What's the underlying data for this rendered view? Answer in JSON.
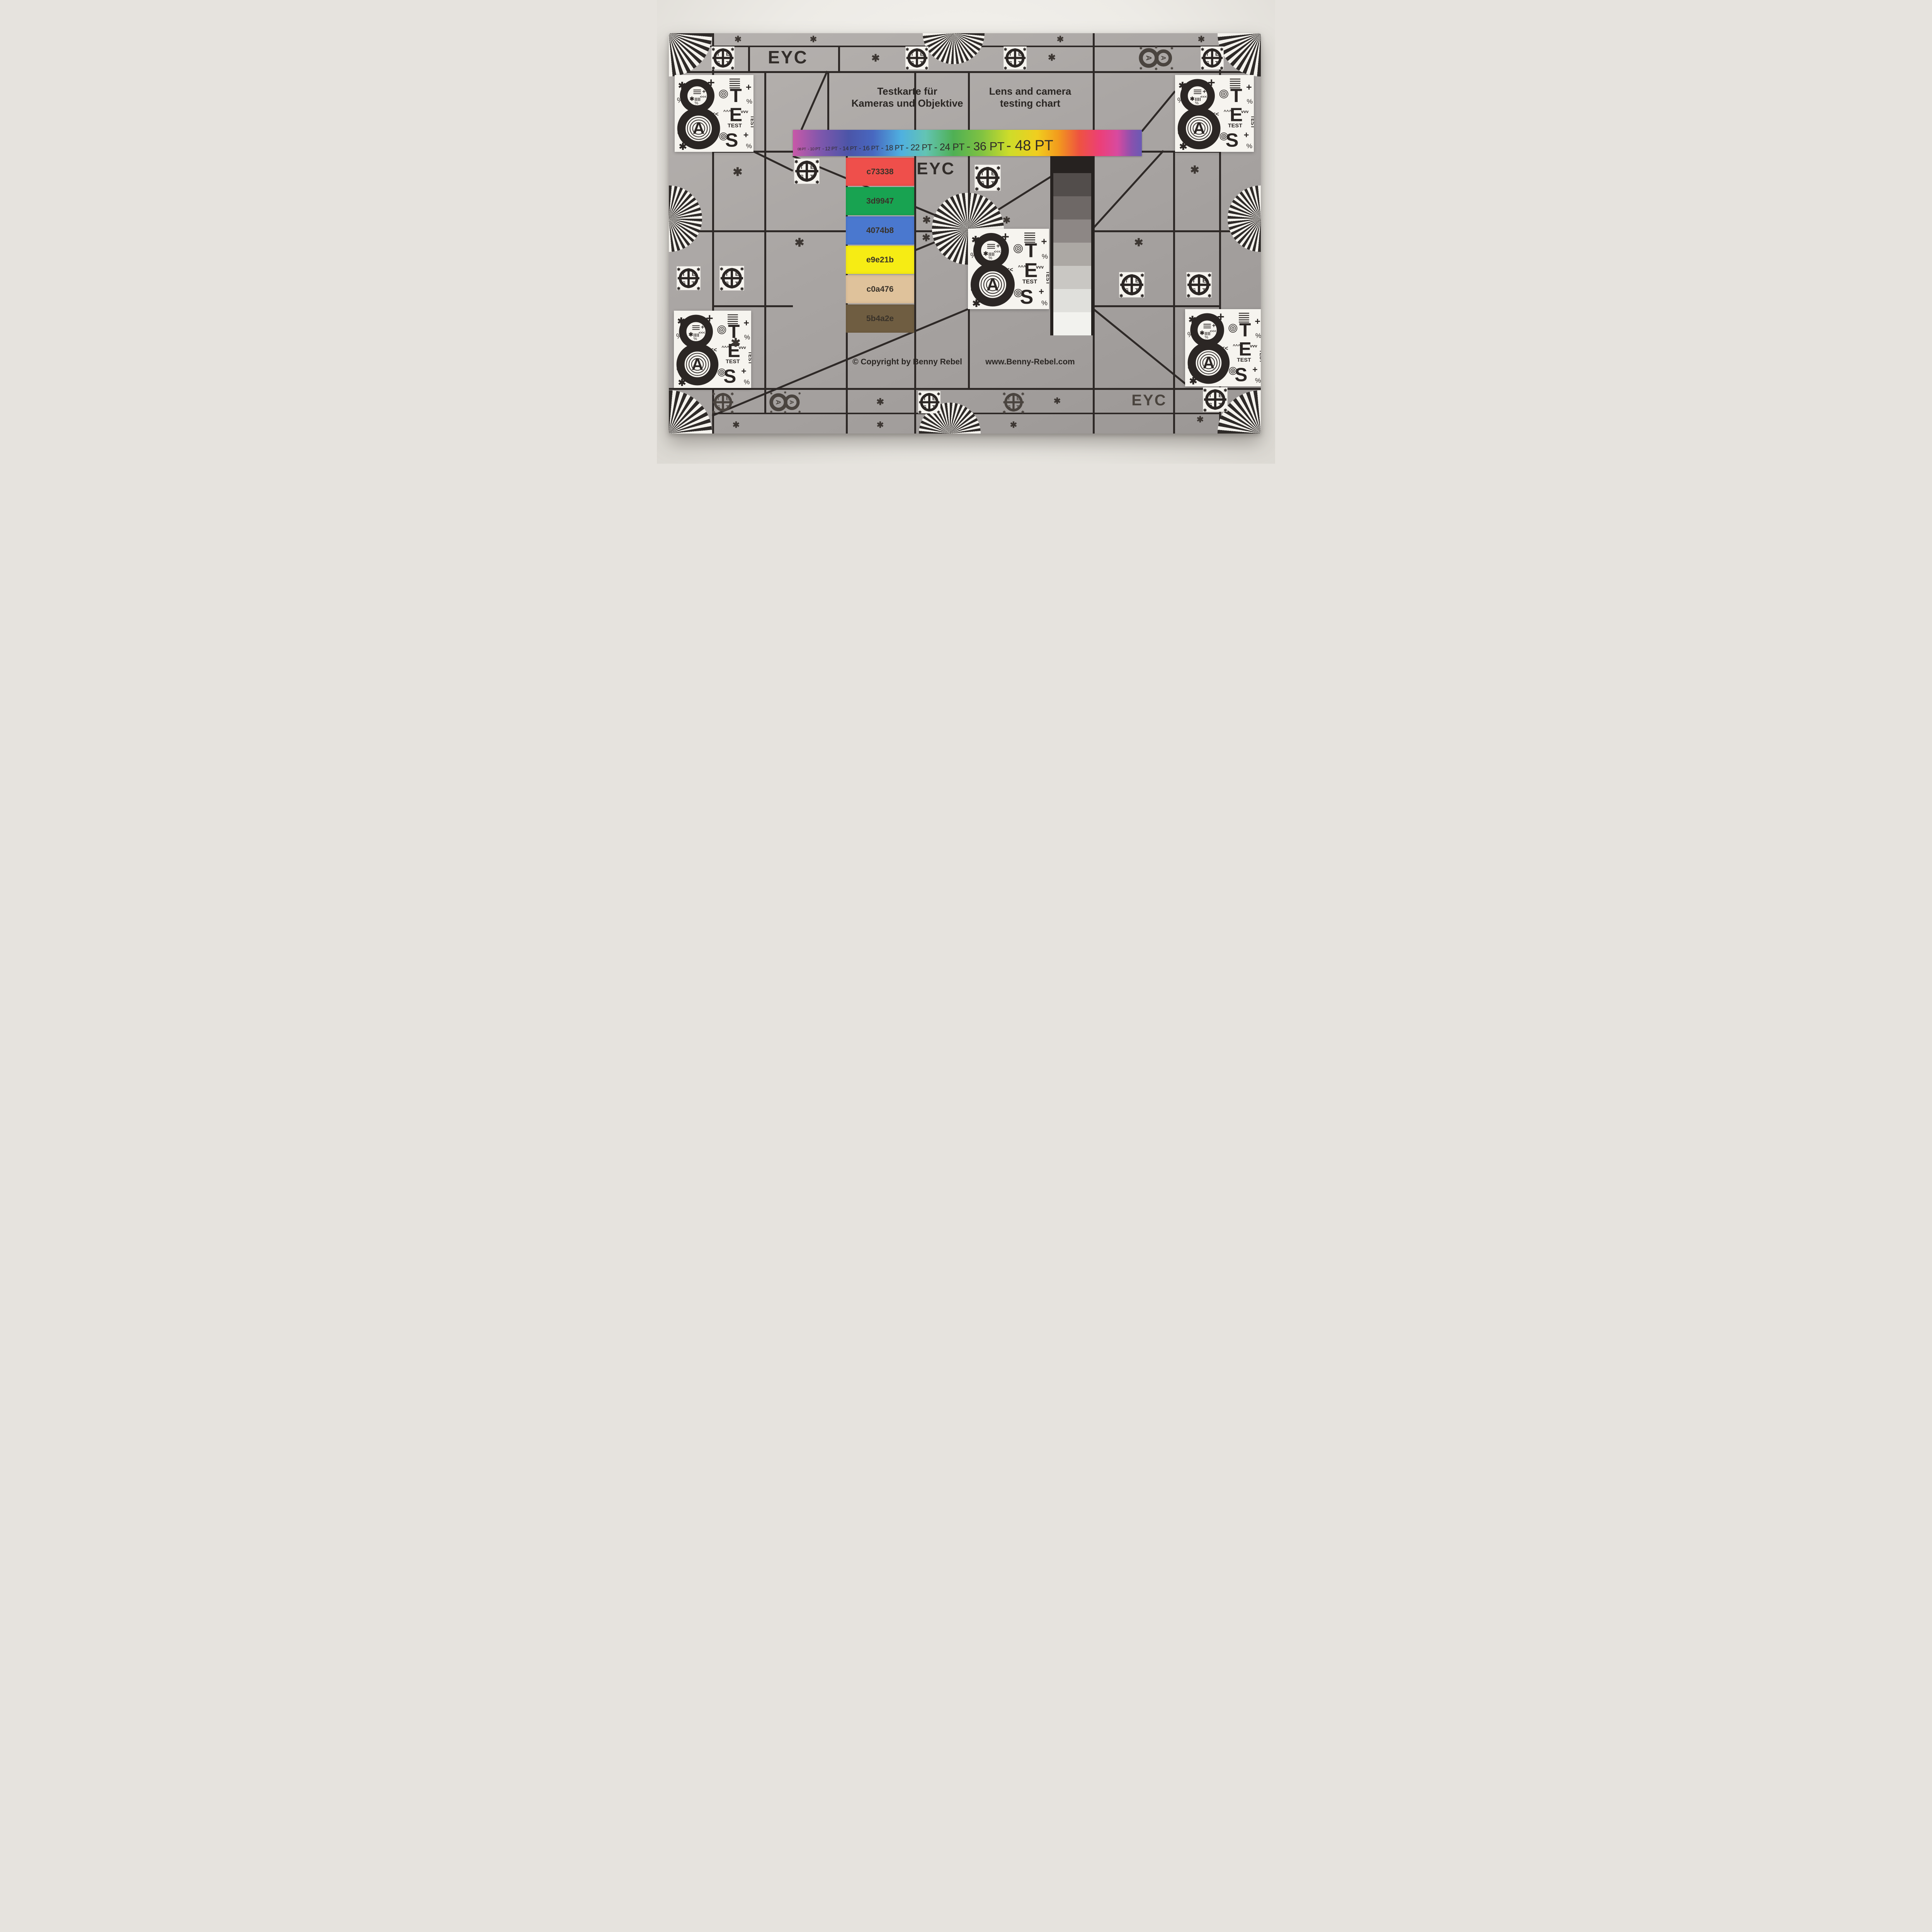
{
  "chart_labels": {
    "eyc": "EYC",
    "title_de": [
      "Testkarte für",
      "Kameras und Objektive"
    ],
    "title_en": [
      "Lens and camera",
      "testing chart"
    ],
    "copyright": "© Copyright by Benny Rebel",
    "website": "www.Benny-Rebel.com"
  },
  "pt_scale": [
    {
      "label": "08 PT",
      "size": 9
    },
    {
      "label": "-  10 PT",
      "size": 11
    },
    {
      "label": "-  12 PT",
      "size": 13
    },
    {
      "label": "- 14 PT",
      "size": 15
    },
    {
      "label": "- 16 PT",
      "size": 17
    },
    {
      "label": "- 18 PT",
      "size": 19
    },
    {
      "label": "- 22 PT",
      "size": 22
    },
    {
      "label": "- 24 PT",
      "size": 25
    },
    {
      "label": "- 36 PT",
      "size": 31
    },
    {
      "label": "- 48 PT",
      "size": 38
    }
  ],
  "rainbow_gradient": [
    "#c858a8 0%",
    "#7e57ac 8%",
    "#4b55a8 16%",
    "#4868c0 23%",
    "#4fb0e0 31%",
    "#63c4b4 38%",
    "#4fb054 46%",
    "#7fc242 54%",
    "#cedc2a 62%",
    "#f0ce1f 70%",
    "#f29b1d 76%",
    "#ee5340 82%",
    "#ec3f78 88%",
    "#d84a9f 93%",
    "#8a51ae 97%",
    "#6a5ab4 100%"
  ],
  "color_swatches": [
    {
      "label": "c73338",
      "display": "#ef4f4b"
    },
    {
      "label": "3d9947",
      "display": "#18a351"
    },
    {
      "label": "4074b8",
      "display": "#4a78cf"
    },
    {
      "label": "e9e21b",
      "display": "#f6ec14"
    },
    {
      "label": "c0a476",
      "display": "#dfc29b"
    },
    {
      "label": "5b4a2e",
      "display": "#6f5d41"
    }
  ],
  "grayscale_steps": [
    {
      "bg": "#524d4b"
    },
    {
      "bg": "#6e6866"
    },
    {
      "bg": "#8d8785"
    },
    {
      "bg": "#aca8a4"
    },
    {
      "bg": "#c9c7c3"
    },
    {
      "bg": "#e0e0dc"
    },
    {
      "bg": "#f2f2ee"
    }
  ],
  "test_logo": {
    "t1": "T",
    "t2": "E",
    "t3": "S",
    "t4": "T"
  },
  "patch": {
    "digit": "8",
    "letter_a": "A",
    "big_t": "T",
    "big_e": "E",
    "big_s": "S",
    "small_test": "TEST",
    "vertical_test": "TEST",
    "chevrons": "<<<",
    "caret_up": "^^^",
    "caret_down": "vvv",
    "plus": "+",
    "percent": "%",
    "asterisk": "✱"
  },
  "icon_8a": {
    "letter": "A",
    "asterisk": "✱"
  },
  "decor": {
    "asterisk": "✱",
    "percent": "%"
  }
}
